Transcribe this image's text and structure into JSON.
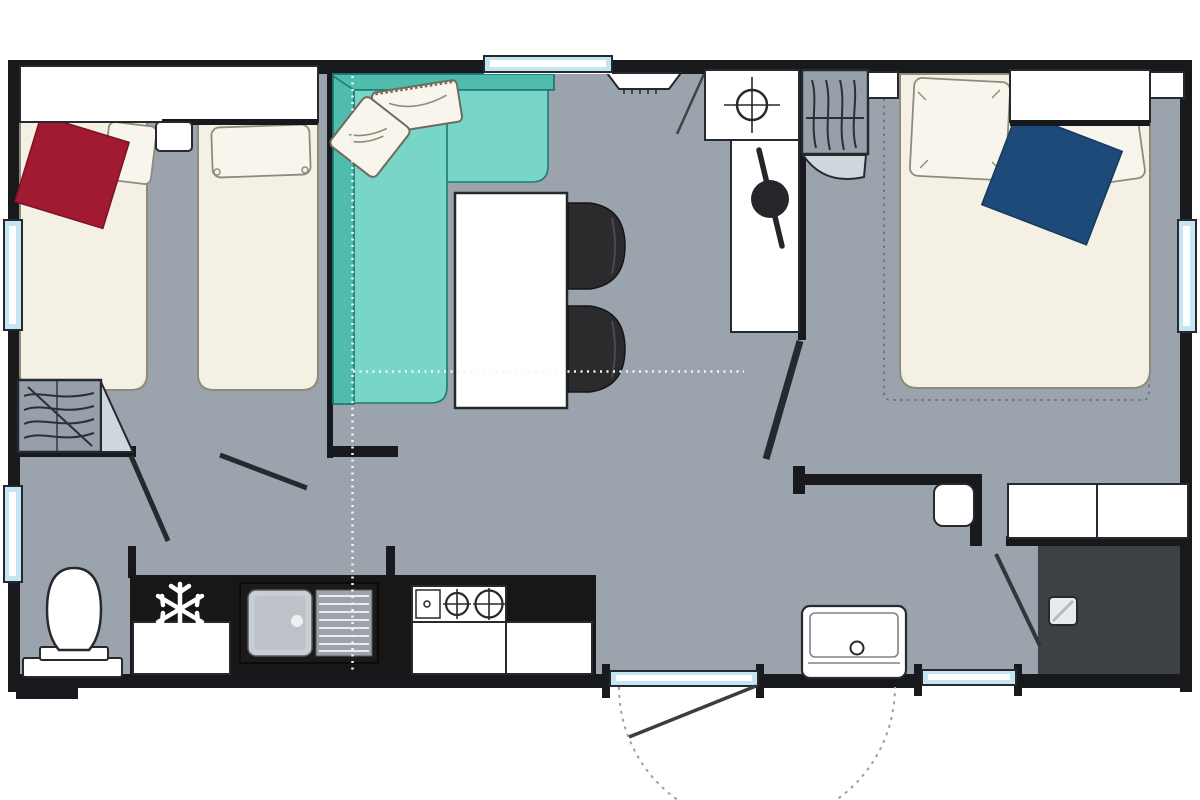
{
  "plan": {
    "description": "Mobile home floor plan with two bedrooms, living-dining area, kitchen, WC and shower room",
    "rooms": {
      "bedroom_twin": "twin bedroom with two single beds",
      "living": "living and dining area with corner sofa, table and chairs",
      "kitchen": "kitchen with fridge, sink and gas hob",
      "wc": "WC with toilet",
      "hall": "hallway",
      "tech": "technical closet with roof vent and water heater",
      "bedroom_double": "double bedroom with double bed and wardrobe",
      "shower_room": "shower room with washbasin and shower"
    },
    "furniture": [
      "single-bed",
      "single-bed",
      "headboard-shelf",
      "nightstand",
      "red-blanket",
      "wardrobe-with-hangers",
      "corner-sofa",
      "sofa-cushions",
      "dining-table",
      "chair",
      "chair",
      "kitchen-counter",
      "refrigerator",
      "kitchen-sink",
      "gas-hob",
      "kitchen-cabinets",
      "toilet",
      "double-bed",
      "navy-blanket",
      "pillows",
      "wardrobe-with-hangers",
      "bedside-shelf",
      "storage-cabinets",
      "washbasin",
      "shower-tray",
      "water-heater",
      "roof-vent",
      "entrance-step"
    ],
    "icons": [
      {
        "name": "snowflake-icon",
        "meaning": "refrigerator position"
      },
      {
        "name": "burner-icon",
        "meaning": "gas hob rings"
      },
      {
        "name": "crosshair-icon",
        "meaning": "roof vent"
      },
      {
        "name": "hanger-icon",
        "meaning": "wardrobe hangers"
      }
    ],
    "counts": {
      "windows": 5,
      "exterior_doors": 1,
      "interior_doors": 5
    }
  },
  "colors": {
    "paper": "#ffffff",
    "floor": "#9ba4ad",
    "wall": "#17191c",
    "outline": "#26292d",
    "cabinet": "#ffffff",
    "bed": "#f4f1e4",
    "bed_outline": "#8e8b7c",
    "pillow": "#f8f6ec",
    "sofa_back": "#4fbcad",
    "sofa_seat": "#77d6c7",
    "sofa_outline": "#1d7b70",
    "blanket_red": "#a11a32",
    "blanket_navy": "#1d4a79",
    "counter": "#181616",
    "steel": "#c9ced2",
    "steel_dark": "#9da3a9",
    "shower": "#3d4044",
    "wardrobe": "#96a0aa",
    "wardrobe_door": "#cfd6dc",
    "window_blue": "#c4e5f4",
    "dot_white": "#f4f6f8",
    "dash_gray": "#70767c",
    "arc_gray": "#9aa0a6",
    "chair": "#2b2b2d",
    "knob": "#242629"
  }
}
